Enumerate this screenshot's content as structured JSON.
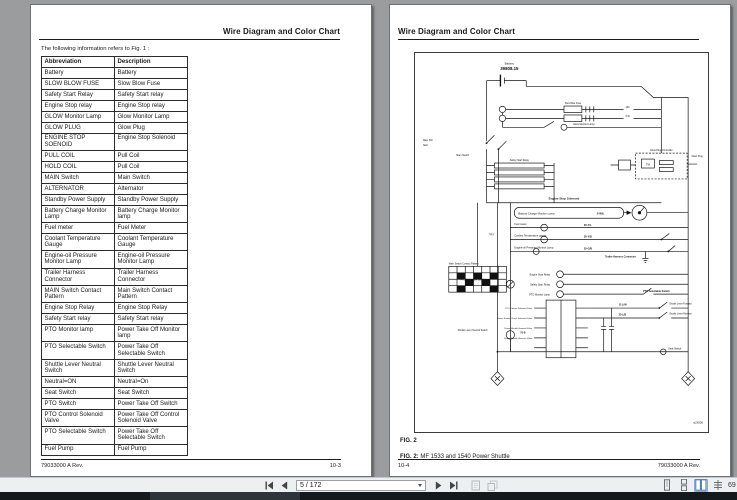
{
  "left_page": {
    "header_title": "Wire Diagram and Color Chart",
    "intro": "The following information refers to Fig. 1 :",
    "table": {
      "headers": [
        "Abbreviation",
        "Description"
      ],
      "rows": [
        [
          "Battery",
          "Battery"
        ],
        [
          "SLOW BLOW FUSE",
          "Slow Blow Fuse"
        ],
        [
          "Safety Start Relay",
          "Safety Start relay"
        ],
        [
          "Engine Stop relay",
          "Engine Stop relay"
        ],
        [
          "GLOW Monitor Lamp",
          "Glow Monitor Lamp"
        ],
        [
          "GLOW PLUG",
          "Glow Plug"
        ],
        [
          "ENGINE STOP SOENOID",
          "Engine Stop Solenoid"
        ],
        [
          "PULL COIL",
          "Pull Coil"
        ],
        [
          "HOLD COIL",
          "Pull Coil"
        ],
        [
          "MAIN Switch",
          "Main Switch"
        ],
        [
          "ALTERNATOR",
          "Alternator"
        ],
        [
          "Standby Power Supply",
          "Standby Power Supply"
        ],
        [
          "Battery Charge Monitor Lamp",
          "Battery Charge Monitor lamp"
        ],
        [
          "Fuel meter",
          "Fuel Meter"
        ],
        [
          "Coolant Temperature Gauge",
          "Coolant Temperature Gauge"
        ],
        [
          "Engine-oil Pressure Monitor Lamp",
          "Engine-oil Pressure Monitor Lamp"
        ],
        [
          "Trailer Harness Connector",
          "Trailer Harness Connector"
        ],
        [
          "MAIN Switch Contact Pattern",
          "Main Switch Contact Pattern"
        ],
        [
          "Engine Stop Relay",
          "Engine Stop Relay"
        ],
        [
          "Safety Start relay",
          "Safety Start relay"
        ],
        [
          "PTO Monitor lamp",
          "Power Take Off Monitor lamp"
        ],
        [
          "PTO Selectable Switch",
          "Power Take Off Selectable Switch"
        ],
        [
          "Shuttle Lever Neutral Switch",
          "Shuttle Lever Neutral Switch"
        ],
        [
          "Neutral=ON",
          "Neutral=On"
        ],
        [
          "Seat Switch",
          "Seat Switch"
        ],
        [
          "PTO Switch",
          "Power Take Off Switch"
        ],
        [
          "PTO Control Solenoid Valve",
          "Power Take Off Control Solenoid Valve"
        ],
        [
          "PTO Selectable Switch",
          "Power Take Off Selectable Switch"
        ],
        [
          "Fuel Pump",
          "Fuel Pump"
        ]
      ]
    },
    "footer_left": "79033000 A Rev.",
    "footer_right": "10-3"
  },
  "right_page": {
    "header_title": "Wire Diagram and Color Chart",
    "fig_label": "FIG. 2",
    "caption_prefix": "FIG. 2:",
    "caption_text": " MF 1533 and 1540 Power Shuttle",
    "diagram_code": "aJ3000",
    "footer_left": "10-4",
    "footer_right": "79033000 A Rev.",
    "diagram_labels": [
      "Battery",
      "39808.15",
      "Main SW",
      "Start",
      "Main Switch",
      "Glow Monitor Lamp",
      "Glow Plug",
      "Engine Stop Solenoid",
      "Glow Plug Controller",
      "Battery Charge Monitor Lamp",
      "5-W/L",
      "Fuel meter",
      "20-Y/L",
      "Coolant Temperature gauge",
      "30-Y/B",
      "Engine-oil Pressure Monitor Lamp",
      "35-G/B",
      "Trailer Harness Connector",
      "Main Switch Contact Pattern",
      "7-R/Y",
      "PTO Selectable Switch",
      "Engine Stop Relay",
      "Safety Start Relay",
      "PTO Monitor Lamp",
      "PTO Control Solenoid Valve",
      "Power Shuttle Check Solenoid Valve",
      "Power Shuttle Forward Valve",
      "Power Shuttle Reverse Valve",
      "11-L/W",
      "23-L/B",
      "Shuttle Lever Forward",
      "Shuttle Lever Reverse",
      "PTO Selectable Switch",
      "Shuttle Lever Neutral Switch",
      "70-B",
      "Seat Switch",
      "TM",
      "15A",
      "5-W",
      "Slow Blow Fuse",
      "Safety Start Relay"
    ]
  },
  "viewer": {
    "toolbar": {
      "page_field_value": "5 / 172",
      "zoom_value": "69"
    }
  }
}
